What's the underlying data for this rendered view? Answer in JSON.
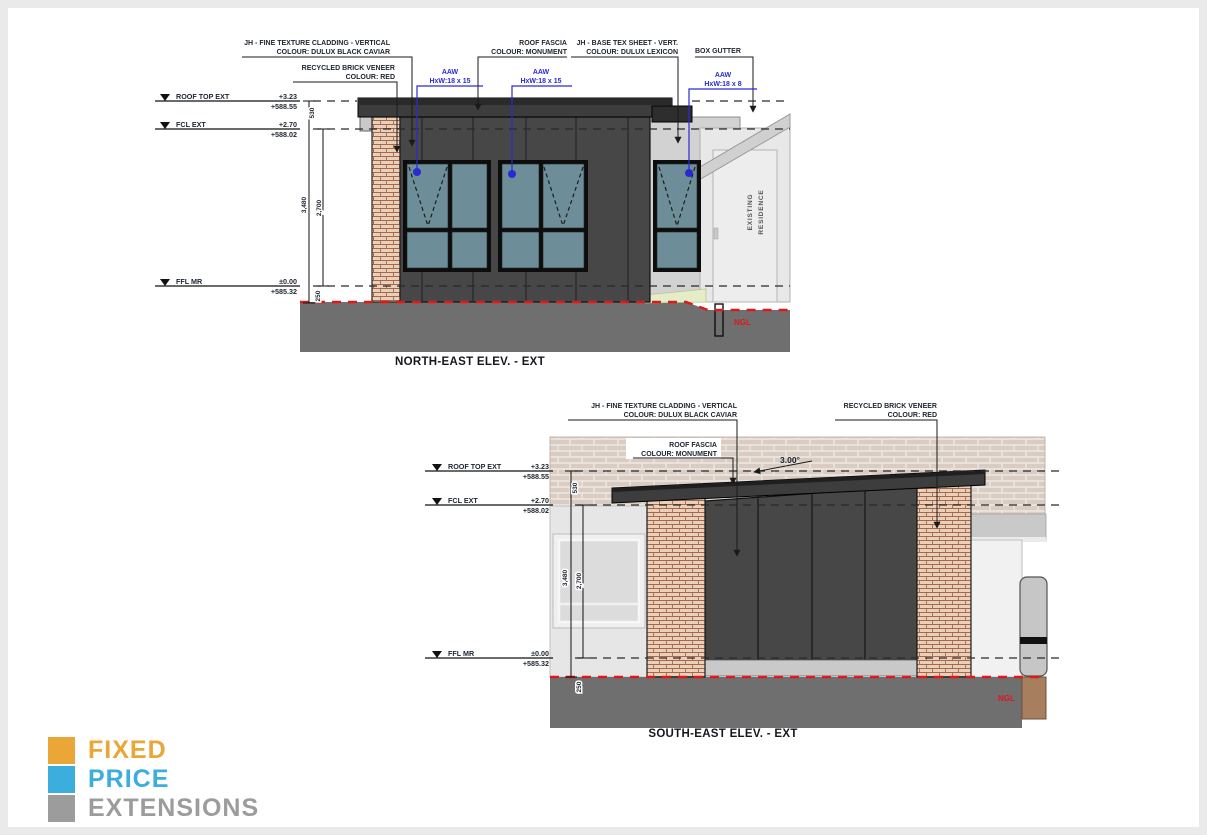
{
  "page": {
    "bg": "#e9eae9",
    "canvas_bg": "#ffffff"
  },
  "palette": {
    "cladding_dark": "#474747",
    "fascia": "#3d3d3d",
    "glass": "#6d8e99",
    "brick_face": "#ead0b8",
    "brick_mortar": "#a2694e",
    "bg_brick_face": "#d8ccc3",
    "bg_brick_mortar": "#efe8e2",
    "ground": "#6f6f6f",
    "ngl_red": "#e01818",
    "leader_blue": "#2a2ad4",
    "soil_brown": "#a87f5e",
    "grass": "#e4ecc8"
  },
  "ne": {
    "title": "NORTH-EAST ELEV. - EXT",
    "ann": {
      "cladding1": "JH - FINE TEXTURE CLADDING - VERTICAL",
      "cladding2": "COLOUR: DULUX BLACK CAVIAR",
      "brick1": "RECYCLED BRICK VENEER",
      "brick2": "COLOUR: RED",
      "fascia1": "ROOF FASCIA",
      "fascia2": "COLOUR: MONUMENT",
      "basetex1": "JH - BASE TEX SHEET - VERT.",
      "basetex2": "COLOUR: DULUX LEXICON",
      "boxgutter": "BOX GUTTER",
      "aaw1a": "AAW",
      "aaw1b": "HxW:18 x 15",
      "aaw2a": "AAW",
      "aaw2b": "HxW:18 x 15",
      "aaw3a": "AAW",
      "aaw3b": "HxW:18 x 8"
    },
    "datums": [
      {
        "name": "ROOF TOP EXT",
        "level": "+3.23",
        "ahd": "+588.55"
      },
      {
        "name": "FCL EXT",
        "level": "+2.70",
        "ahd": "+588.02"
      },
      {
        "name": "FFL MR",
        "level": "±0.00",
        "ahd": "+585.32"
      }
    ],
    "dims": {
      "a": "3,480",
      "b": "2,700",
      "top": "530",
      "bot": "250"
    },
    "ngl": "NGL",
    "existing1": "EXISTING",
    "existing2": "RESIDENCE"
  },
  "se": {
    "title": "SOUTH-EAST ELEV. - EXT",
    "ann": {
      "cladding1": "JH - FINE TEXTURE CLADDING - VERTICAL",
      "cladding2": "COLOUR: DULUX BLACK CAVIAR",
      "brick1": "RECYCLED BRICK VENEER",
      "brick2": "COLOUR: RED",
      "fascia1": "ROOF FASCIA",
      "fascia2": "COLOUR: MONUMENT",
      "pitch": "3.00°"
    },
    "datums": [
      {
        "name": "ROOF TOP EXT",
        "level": "+3.23",
        "ahd": "+588.55"
      },
      {
        "name": "FCL EXT",
        "level": "+2.70",
        "ahd": "+588.02"
      },
      {
        "name": "FFL MR",
        "level": "±0.00",
        "ahd": "+585.32"
      }
    ],
    "dims": {
      "a": "3,480",
      "b": "2,700",
      "top": "530",
      "bot": "250"
    },
    "ngl": "NGL"
  },
  "logo": {
    "word1": "FIXED",
    "word2": "PRICE",
    "word3": "EXTENSIONS",
    "color1": "#EAA636",
    "color2": "#3BAEDD",
    "color3": "#9C9C9C"
  }
}
